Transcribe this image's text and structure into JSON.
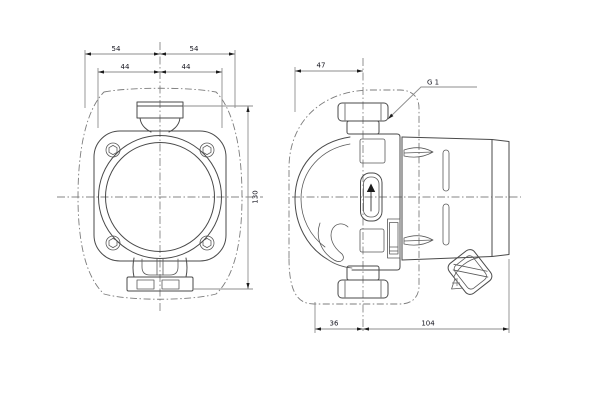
{
  "drawing": {
    "colors": {
      "background": "#ffffff",
      "object_line": "#4a4a4a",
      "dimension_line": "#8d8d8d",
      "centerline": "#858585",
      "text": "#14141e"
    },
    "front_view": {
      "dim_outer_left": "54",
      "dim_outer_right": "54",
      "dim_inner_left": "44",
      "dim_inner_right": "44",
      "dim_height": "130"
    },
    "side_view": {
      "dim_top": "47",
      "thread_label": "G 1",
      "dim_bottom_left": "36",
      "dim_bottom_right": "104"
    }
  }
}
